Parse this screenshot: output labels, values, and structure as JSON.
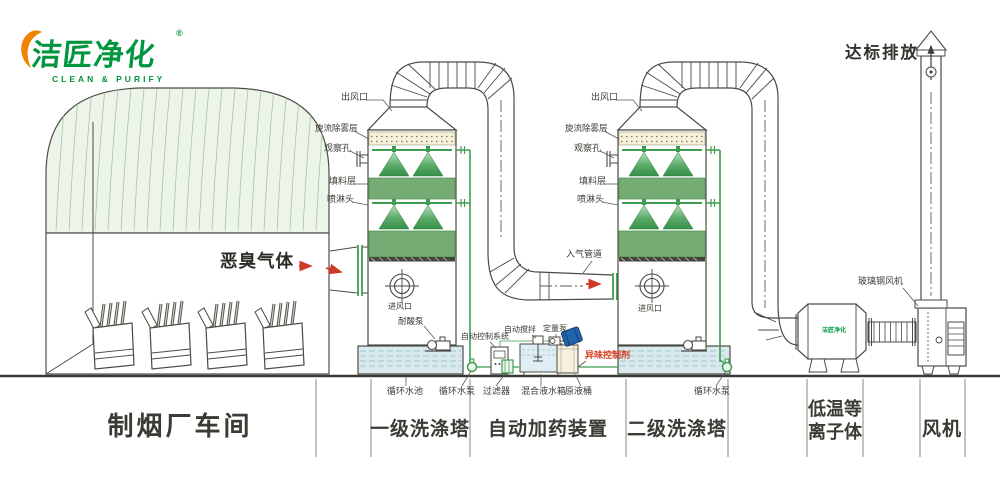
{
  "logo": {
    "brand": "洁匠净化",
    "registered": "®",
    "tagline": "CLEAN & PURIFY"
  },
  "headline": {
    "emission": "达标排放"
  },
  "factory": {
    "gas_label": "恶臭气体"
  },
  "tower1": {
    "outlet": "出风口",
    "demister": "旋流除雾层",
    "window": "观察孔",
    "packing": "填料层",
    "spray": "喷淋头",
    "inlet": "进风口",
    "acid_pump": "耐酸泵",
    "pool": "循环水池",
    "pump": "循环水泵"
  },
  "tower2": {
    "outlet": "出风口",
    "demister": "旋流除雾层",
    "window": "观察孔",
    "packing": "填料层",
    "spray": "喷淋头",
    "inlet": "进风口",
    "inlet_duct": "入气管道",
    "pump": "循环水泵"
  },
  "dosing": {
    "control": "自动控制系统",
    "stirrer": "自动搅拌",
    "meter_pump": "定量泵",
    "agent": "异味控制剂",
    "filter": "过滤器",
    "tank": "混合液水箱",
    "barrel": "原液桶"
  },
  "plasma": {
    "device_logo": "洁匠净化"
  },
  "fan": {
    "frp_fan": "玻璃钢风机"
  },
  "sections": {
    "factory": "制烟厂车间",
    "tower1": "一级洗涤塔",
    "dosing": "自动加药装置",
    "tower2": "二级洗涤塔",
    "plasma": "低温等离子体",
    "fan": "风机"
  },
  "colors": {
    "pipe_green": "#3f9d4f",
    "packing_green": "#74ac74",
    "demister_cream": "#f6f1d7",
    "water_blue": "#d9eaee",
    "arrow_red": "#cf3a27",
    "logo_green": "#00963f",
    "logo_orange": "#f08300",
    "line_dark": "#4a4a44",
    "roof_tint": "#edf5ea",
    "drum_blue": "#2263ae"
  }
}
